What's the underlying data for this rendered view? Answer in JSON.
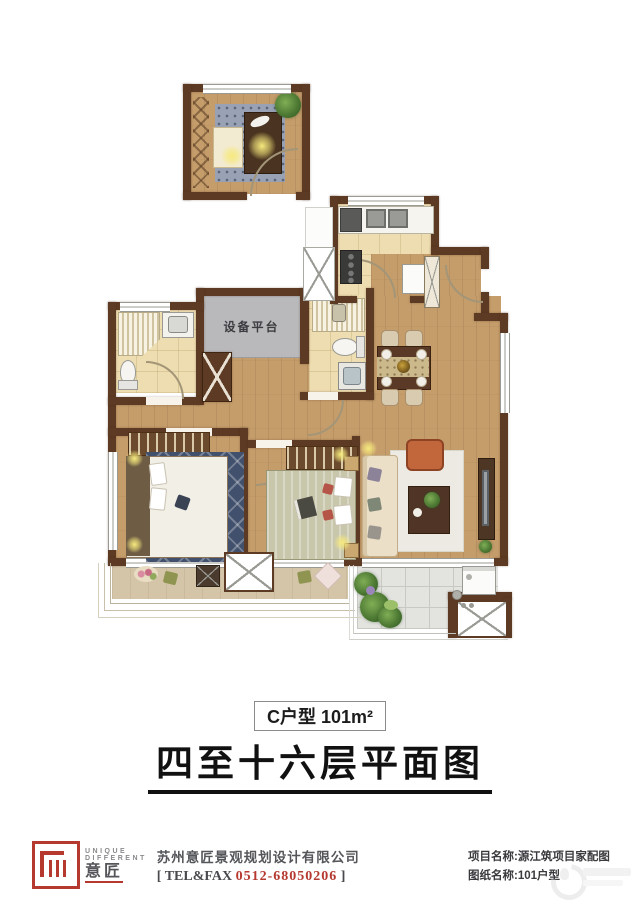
{
  "plan": {
    "equipment_platform_label": "设备平台"
  },
  "title": {
    "unit_label": "C户型 101m²",
    "main_title": "四至十六层平面图"
  },
  "footer": {
    "logo_line1": "UNIQUE",
    "logo_line2": "DIFFERENT",
    "logo_cn": "意匠",
    "company_name": "苏州意匠景观规划设计有限公司",
    "tel_open_bracket": "[",
    "tel_label": "TEL&FAX",
    "tel_number": "0512-68050206",
    "tel_close_bracket": "]",
    "project_name_line": "项目名称:源江筑项目家配图",
    "drawing_name_line": "图纸名称:101户型"
  },
  "colors": {
    "wall_brown": "#5d3a23",
    "wood_floor": "#c59d6b",
    "tile_cream": "#eeddb0",
    "platform_gray": "#b9b9bb",
    "accent_red": "#b5392f",
    "highlight_yellow": "#f6e97d"
  }
}
